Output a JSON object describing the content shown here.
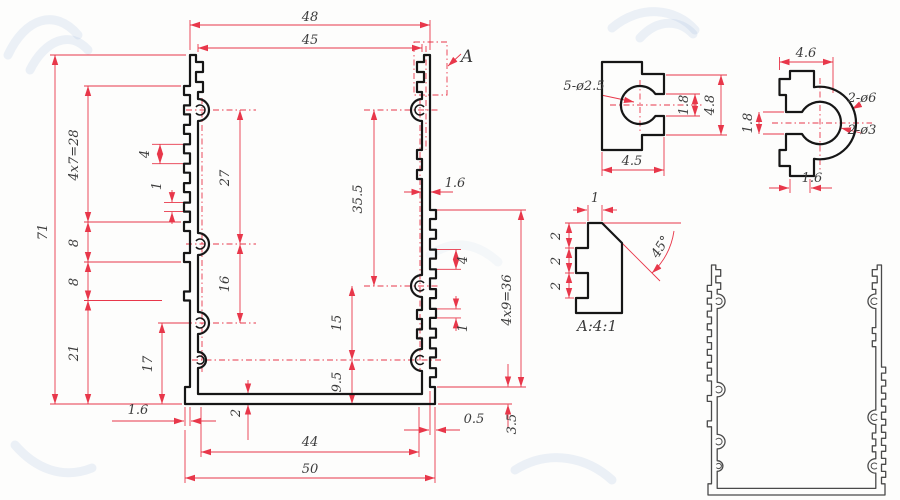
{
  "colors": {
    "dimension_red": "#e8374a",
    "profile_black": "#161616",
    "profile_gray": "#4a4a4a",
    "watermark_blue": "#85abd6",
    "text_gray": "#3c3c3c"
  },
  "main_view": {
    "width_outer": "48",
    "width_inner": "45",
    "height": "71",
    "serration_left": "4x7=28",
    "pitch_left": "4",
    "tooth_left": "1",
    "boss_gap_top_left": "27",
    "step_a": "8",
    "step_b": "8",
    "boss_gap_bottom_left": "16",
    "lower_left": "21",
    "inner_lower_left": "17",
    "overhang_left": "1.6",
    "wall_right": "1.6",
    "boss_gap_top_right": "35.5",
    "pitch_right": "4",
    "tooth_right": "1",
    "boss_gap_bottom_right": "15",
    "floor_right": "9.5",
    "serration_right": "4x9=36",
    "floor_thickness": "2",
    "inner_width_bottom": "44",
    "base_width": "50",
    "overhang_right": "0.5",
    "base_thickness": "3.5",
    "callout": "A"
  },
  "detail_screw_boss": {
    "holes": "5-ø2.5",
    "slot": "1.8",
    "height": "4.8",
    "width": "4.5"
  },
  "detail_horseshoe": {
    "width": "4.6",
    "slot": "1.8",
    "lip": "1.6",
    "outer_holes": "2-ø6",
    "inner_holes": "2-ø3"
  },
  "detail_a": {
    "tooth": "1",
    "s1": "2",
    "s2": "2",
    "s3": "2",
    "angle": "45°",
    "caption": "A:4:1"
  }
}
